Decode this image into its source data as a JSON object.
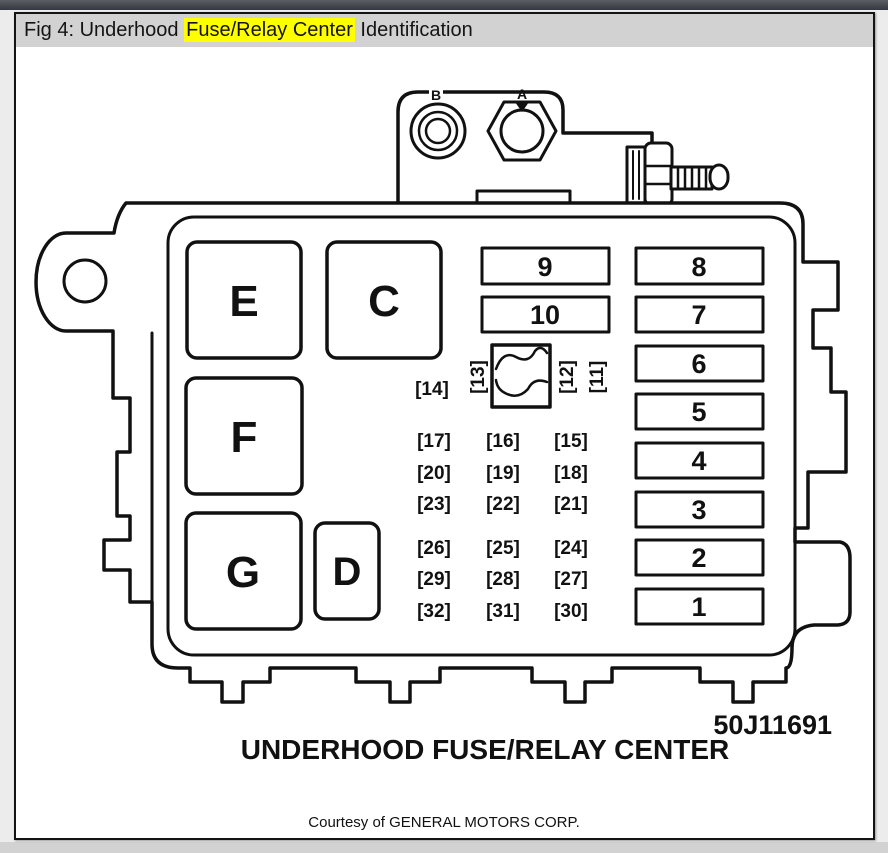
{
  "header": {
    "prefix": "Fig 4: Underhood ",
    "highlight": "Fuse/Relay Center",
    "suffix": " Identification",
    "highlight_color": "#ffff00",
    "bar_color": "#d2d2d2"
  },
  "diagram": {
    "fastener_labels": {
      "b": "B",
      "a": "A"
    },
    "relay_labels": {
      "e": "E",
      "c": "C",
      "f": "F",
      "g": "G",
      "d": "D"
    },
    "slots": [
      "9",
      "10",
      "8",
      "7",
      "6",
      "5",
      "4",
      "3",
      "2",
      "1"
    ],
    "mini_fuses_top": [
      "[14]",
      "[13]",
      "[12]",
      "[11]"
    ],
    "fuse_grid": [
      [
        "[17]",
        "[16]",
        "[15]"
      ],
      [
        "[20]",
        "[19]",
        "[18]"
      ],
      [
        "[23]",
        "[22]",
        "[21]"
      ],
      [
        "[26]",
        "[25]",
        "[24]"
      ],
      [
        "[29]",
        "[28]",
        "[27]"
      ],
      [
        "[32]",
        "[31]",
        "[30]"
      ]
    ],
    "part_number": "50J11691",
    "caption": "UNDERHOOD FUSE/RELAY CENTER"
  },
  "footer": {
    "courtesy": "Courtesy of GENERAL MOTORS CORP."
  }
}
